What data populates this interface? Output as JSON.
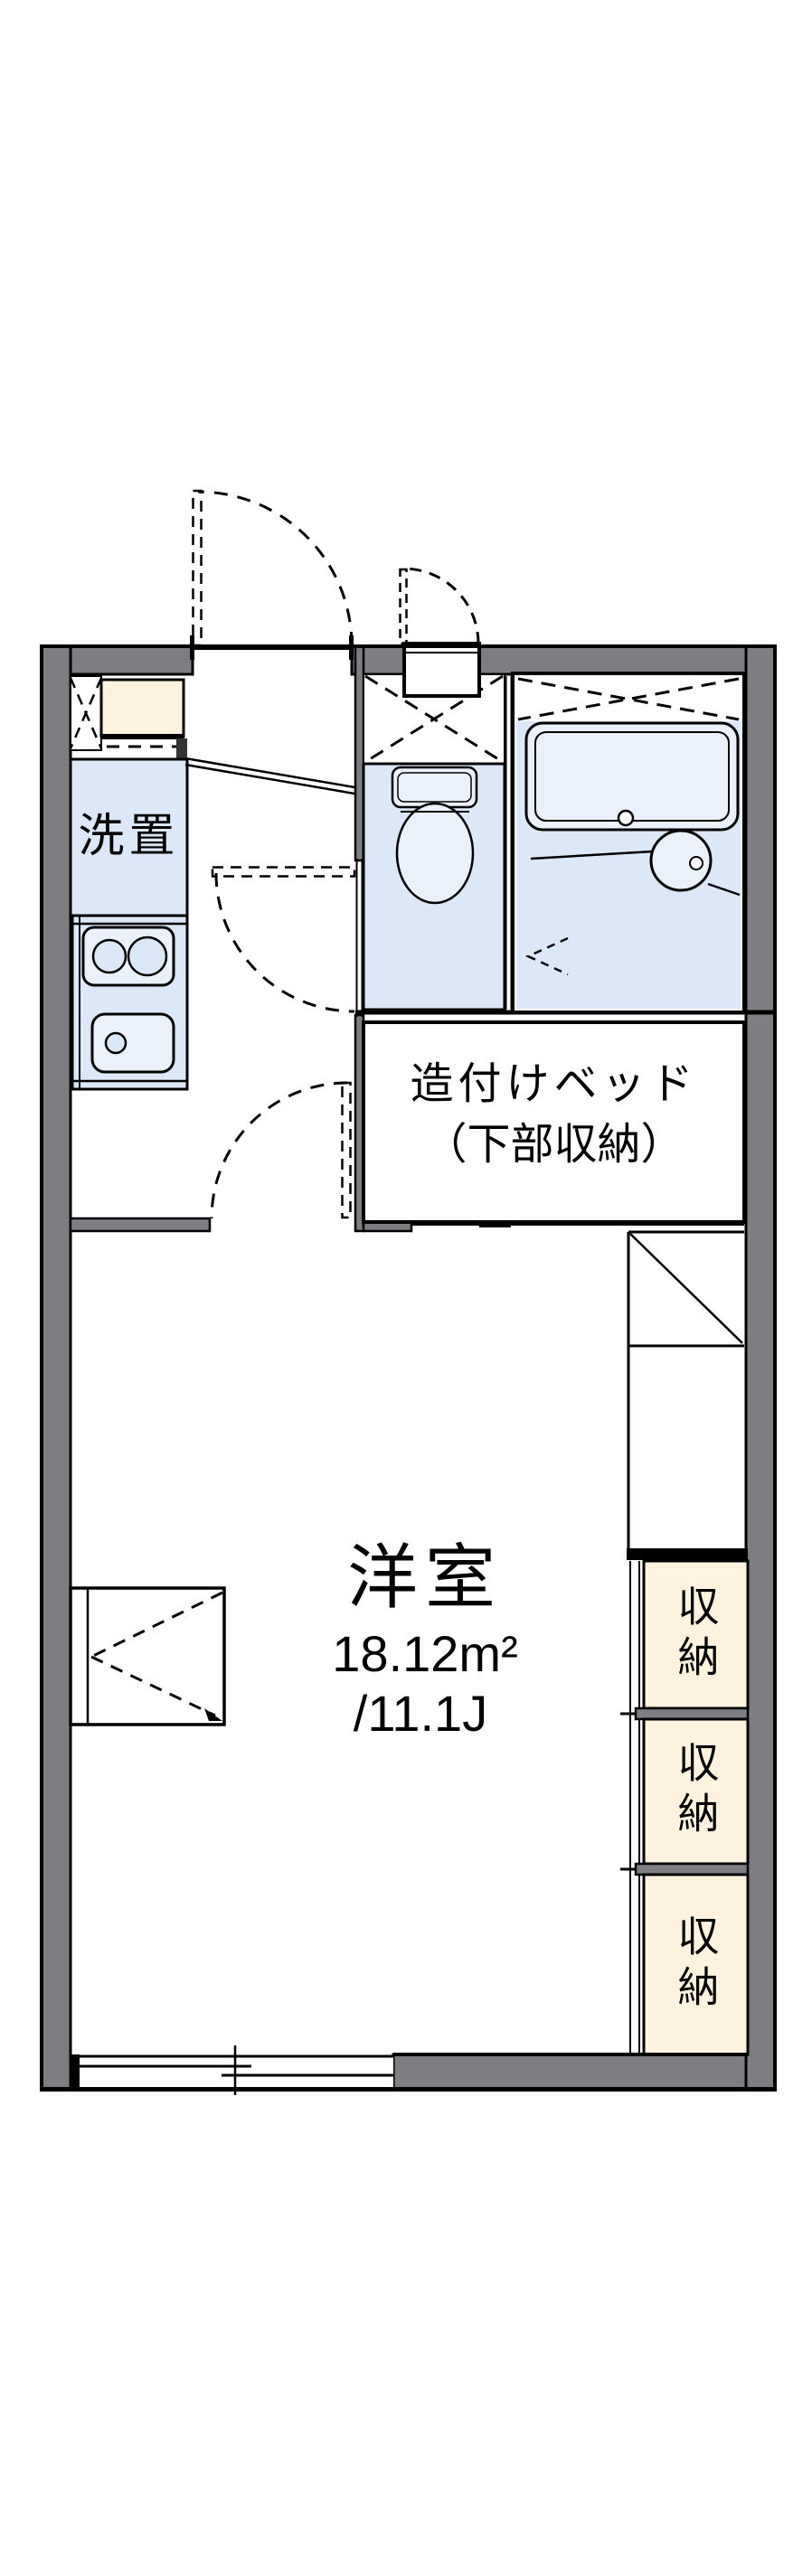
{
  "floorplan": {
    "colors": {
      "wall": "#7e7e82",
      "water": "#dce8f8",
      "fixture": "#eaf1fb",
      "storage_fill": "#fcf2dd",
      "line": "#000000"
    },
    "kitchen": {
      "laundry_label": "洗置"
    },
    "bed": {
      "line1": "造付けベッド",
      "line2": "（下部収納）"
    },
    "main_room": {
      "name": "洋室",
      "area_m2": "18.12m²",
      "area_jo": "/11.1J"
    },
    "storage": {
      "items": [
        {
          "label": "収納"
        },
        {
          "label": "収納"
        },
        {
          "label": "収納"
        }
      ]
    }
  }
}
